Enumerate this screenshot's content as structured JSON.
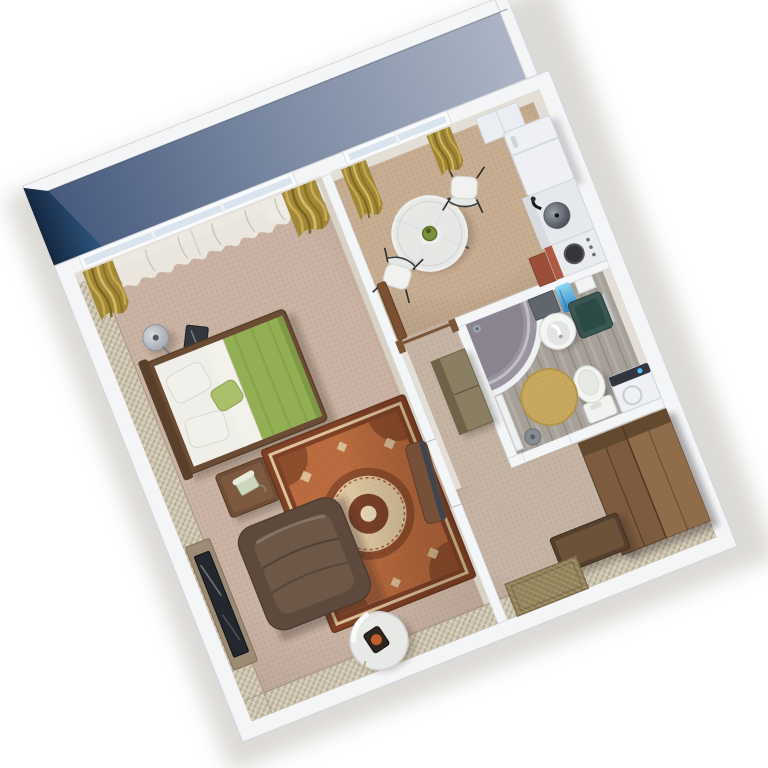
{
  "meta": {
    "type": "3d-floorplan-render",
    "description": "Top-down isometric 3D rendering of a one-room apartment with balcony, living room, kitchen, bathroom and hallway; no visible text in image",
    "background": "#ffffff",
    "plan_rotation_deg": -21.6
  },
  "palette": {
    "wall_top": "#f4f5f7",
    "wall_edge": "#d6d8dc",
    "wallpaper": "#cfc7b4",
    "stone": "#e3dfd6",
    "floor_living": "#c9b2a3",
    "floor_kitchen": "#c6ac90",
    "floor_hall": "#c4b2a3",
    "floor_bath": "#a7a099",
    "balcony_dark": "#1c3a5f",
    "curtain_gold": "#a98d3a",
    "sheer": "#edeae2",
    "bed_frame": "#6a4b33",
    "duvet": "#93af54",
    "pillow": "#f1f0ea",
    "nightstand": "#6f4e36",
    "armchair": "#5e4a3c",
    "rug_border": "#7e4126",
    "rug_field": "#b96a3e",
    "rug_cream": "#ddc29a",
    "wood_board": "#9c8b75",
    "tv": "#24272d",
    "glass": "#eceeed",
    "chair": "#f1f2f0",
    "appliance": "#eef0f4",
    "stove_red": "#ad5a43",
    "shower_basin": "#9a93a0",
    "bath_rug": "#c8a85c",
    "towel_blue": "#45a3dd",
    "mirror_teal": "#3a5753",
    "wardrobe": "#7c5b3e",
    "bench": "#55402e",
    "doormat": "#95855c"
  },
  "rooms": [
    {
      "id": "balcony",
      "label": "balcony",
      "items": [
        "balcony-floor",
        "parapet",
        "dark-side-wall"
      ]
    },
    {
      "id": "living-room",
      "label": "living room",
      "items": [
        "sheer-curtain",
        "gold-drapes",
        "radiator",
        "floor-lamp",
        "double-bed",
        "green-duvet",
        "pillows",
        "nightstand",
        "telephone",
        "armchair",
        "persian-rug",
        "tv-console",
        "tv",
        "glass-side-table",
        "open-door"
      ]
    },
    {
      "id": "kitchen",
      "label": "kitchen",
      "items": [
        "gold-drapes",
        "round-glass-table",
        "vase",
        "dining-chair",
        "dining-chair",
        "wall-cabinet",
        "refrigerator",
        "sink-counter",
        "stove",
        "door-frame"
      ]
    },
    {
      "id": "bathroom",
      "label": "bathroom",
      "items": [
        "corner-shower",
        "washbasin",
        "glass-mirror-panel",
        "wall-shelf",
        "blue-towel",
        "toilet",
        "washing-machine",
        "round-rug",
        "waste-bin"
      ]
    },
    {
      "id": "hallway",
      "label": "hallway",
      "items": [
        "corridor-cabinet",
        "wardrobe",
        "shoe-bench",
        "doormat"
      ]
    }
  ]
}
